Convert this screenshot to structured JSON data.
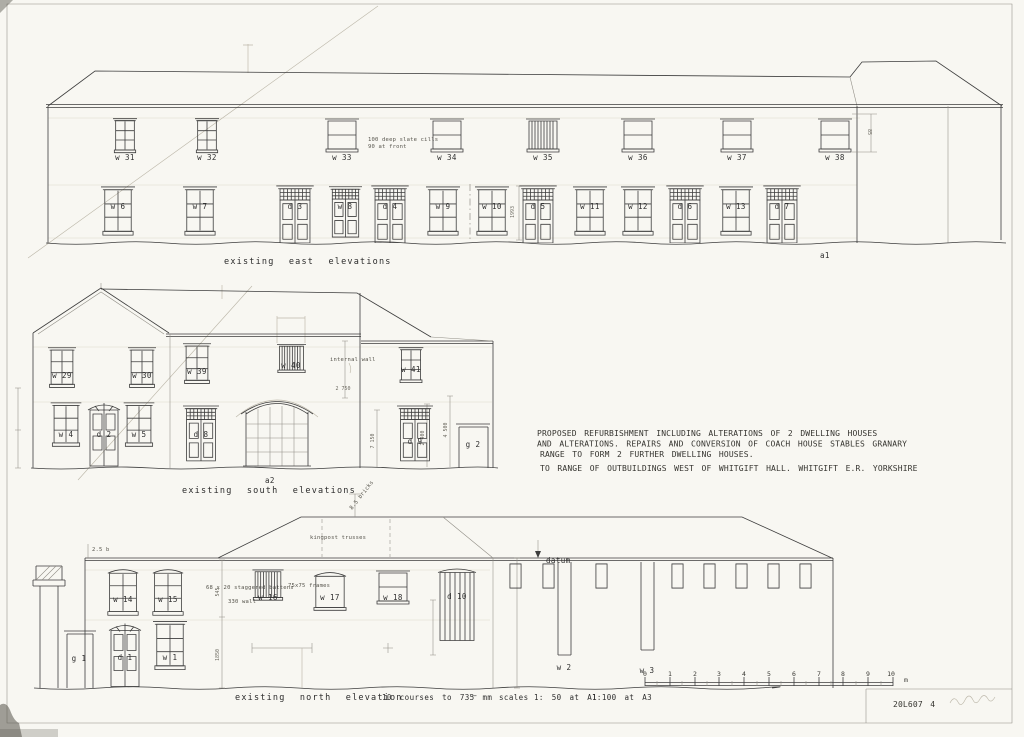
{
  "notes": {
    "line1": "PROPOSED REFURBISHMENT INCLUDING ALTERATIONS OF 2 DWELLING HOUSES",
    "line2": "AND ALTERATIONS. REPAIRS AND CONVERSION OF COACH HOUSE STABLES GRANARY",
    "line3": "RANGE TO FORM 2 FURTHER DWELLING HOUSES.",
    "line4": "TO RANGE OF OUTBUILDINGS WEST OF WHITGIFT HALL. WHITGIFT E.R. YORKSHIRE"
  },
  "east": {
    "caption": "existing east elevations",
    "ref": "a1",
    "cill_note_1": "100 deep slate cills",
    "cill_note_2": "90 at front",
    "dim_height": "1993",
    "dim_right": "85",
    "upper": [
      "w 31",
      "w 32",
      "w 33",
      "w 34",
      "w 35",
      "w 36",
      "w 37",
      "w 38"
    ],
    "lower": [
      "w 6",
      "w 7",
      "d 3",
      "w 8",
      "d 4",
      "w 9",
      "w 10",
      "d 5",
      "w 11",
      "w 12",
      "d 6",
      "w 13",
      "d 7"
    ]
  },
  "south": {
    "caption": "existing south elevations",
    "ref": "a2",
    "note_internal_wall": "internal wall",
    "dim_2750": "2 750",
    "dim_2400": "2 400",
    "dim_4500": "4 500",
    "dim_7150": "7 150",
    "upper": [
      "w 29",
      "w 30",
      "w 39",
      "w 40",
      "w 41"
    ],
    "lower": [
      "w 4",
      "d 2",
      "w 5",
      "d 8",
      "d 9",
      "g 2"
    ]
  },
  "north": {
    "caption": "existing north elevation",
    "courses_note": "10 courses to 735 mm",
    "separator": "—",
    "scales_label": "scales",
    "scale_a1": "1: 50 at A1",
    "scale_a3": "1:100 at A3",
    "datum_label": "datum",
    "note_kingpost": "kingpost trusses",
    "note_bricks_roof": "8.5 bricks",
    "note_bricks_wall": "2.5 b",
    "note_battens": "68 x 20 staggered battens",
    "note_wall": "330 wall",
    "note_frames": "75x75 frames",
    "dim_545": "545",
    "dim_1850": "1850",
    "upper": [
      "w 14",
      "w 15",
      "w 16",
      "w 17",
      "w 18",
      "d 10"
    ],
    "lower": [
      "g 1",
      "d 1",
      "w 1",
      "w 2",
      "w 3"
    ]
  },
  "scalebar": {
    "ticks": [
      "0",
      "1",
      "2",
      "3",
      "4",
      "5",
      "6",
      "7",
      "8",
      "9",
      "10"
    ],
    "unit": "m"
  },
  "titleblock": {
    "drawing_number": "20L607 4"
  },
  "colors": {
    "paper": "#f8f7f2",
    "ink": "#3d3d3d",
    "pencil": "#bdb8aa"
  }
}
